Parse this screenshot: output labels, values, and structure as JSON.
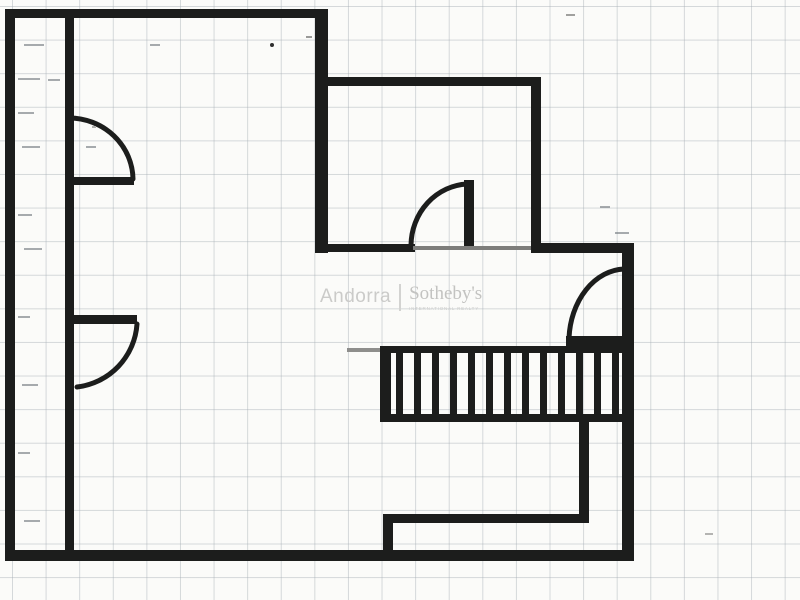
{
  "document": {
    "kind": "scanned floor plan on graph paper",
    "paper_color": "#fbfbf9",
    "grid_color": "#a5adb4",
    "wall_color": "#1c1d1c",
    "faint_wall_color": "#7d7d7b",
    "watermark_color": "#c7c7c5"
  },
  "watermark": {
    "brand_left": "Andorra",
    "brand_right": "Sotheby's",
    "brand_tagline": "INTERNATIONAL REALTY"
  },
  "stairs": {
    "tread_count": 13,
    "x_start": 396,
    "x_step": 18.0,
    "tread_width": 7,
    "y_top": 352,
    "tread_height": 63
  },
  "scan_marks": {
    "dashes": [
      {
        "x": 24,
        "y": 44,
        "w": 20
      },
      {
        "x": 150,
        "y": 44,
        "w": 10
      },
      {
        "x": 18,
        "y": 78,
        "w": 22
      },
      {
        "x": 48,
        "y": 79,
        "w": 12
      },
      {
        "x": 18,
        "y": 112,
        "w": 16
      },
      {
        "x": 22,
        "y": 146,
        "w": 18
      },
      {
        "x": 86,
        "y": 146,
        "w": 10
      },
      {
        "x": 18,
        "y": 214,
        "w": 14
      },
      {
        "x": 24,
        "y": 248,
        "w": 18
      },
      {
        "x": 18,
        "y": 316,
        "w": 12
      },
      {
        "x": 22,
        "y": 384,
        "w": 16
      },
      {
        "x": 18,
        "y": 452,
        "w": 12
      },
      {
        "x": 24,
        "y": 520,
        "w": 16
      },
      {
        "x": 600,
        "y": 206,
        "w": 10
      },
      {
        "x": 615,
        "y": 232,
        "w": 14
      }
    ],
    "specks": [
      {
        "x": 270,
        "y": 43,
        "w": 4,
        "h": 4,
        "round": true,
        "color": "#2f2f2f"
      },
      {
        "x": 306,
        "y": 36,
        "w": 6,
        "h": 2,
        "round": false,
        "color": "#9a9a98"
      },
      {
        "x": 566,
        "y": 14,
        "w": 9,
        "h": 2,
        "round": false,
        "color": "#a0a09e"
      },
      {
        "x": 92,
        "y": 126,
        "w": 4,
        "h": 2,
        "round": false,
        "color": "#b0b0ae"
      },
      {
        "x": 705,
        "y": 533,
        "w": 8,
        "h": 2,
        "round": false,
        "color": "#b4b4b2"
      }
    ]
  }
}
